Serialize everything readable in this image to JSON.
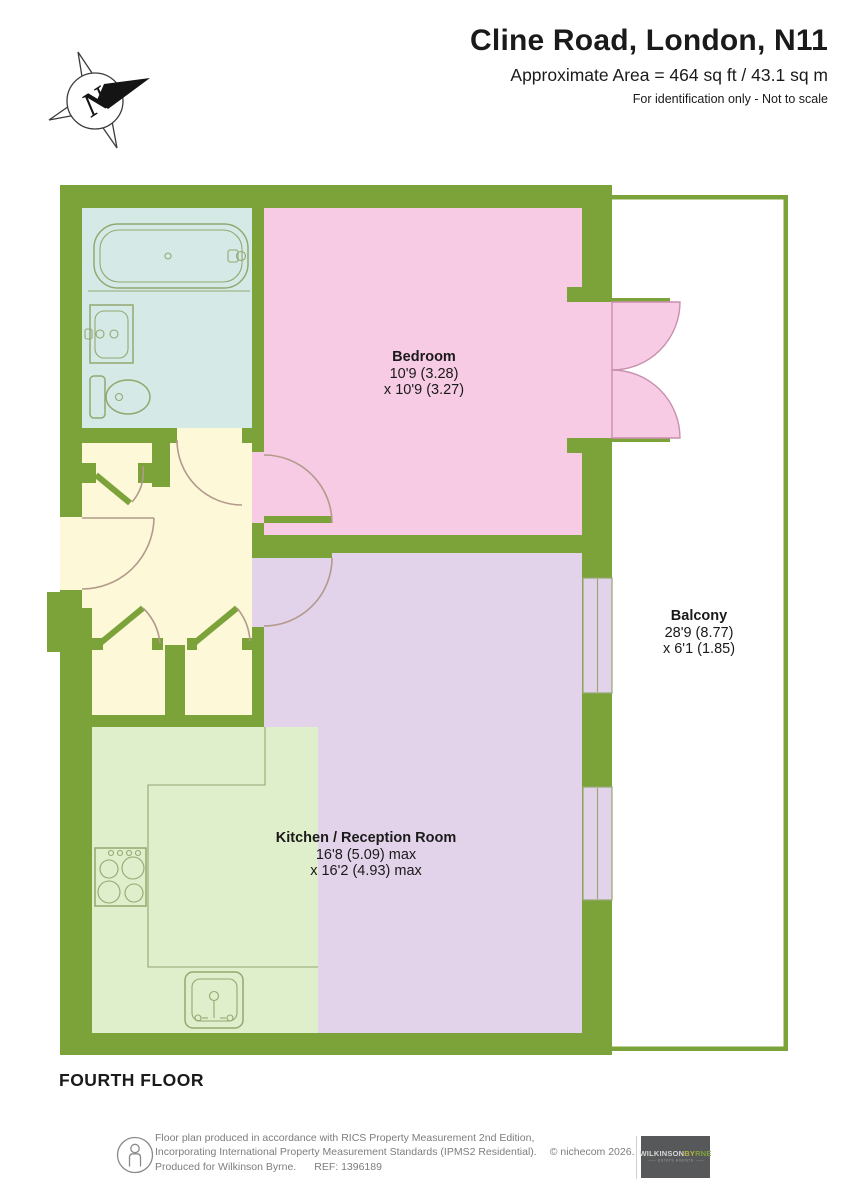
{
  "header": {
    "title": "Cline Road, London, N11",
    "area": "Approximate Area = 464 sq ft / 43.1 sq m",
    "disclaimer": "For identification only - Not to scale"
  },
  "compass": {
    "north_label": "N"
  },
  "plan": {
    "floor_label": "FOURTH FLOOR",
    "rooms": [
      {
        "name": "Bedroom",
        "dim_line1": "10'9 (3.28)",
        "dim_line2": "x 10'9 (3.27)"
      },
      {
        "name": "Balcony",
        "dim_line1": "28'9 (8.77)",
        "dim_line2": "x 6'1 (1.85)"
      },
      {
        "name": "Kitchen / Reception Room",
        "dim_line1": "16'8 (5.09) max",
        "dim_line2": "x 16'2 (4.93) max"
      }
    ]
  },
  "footer": {
    "line1": "Floor plan produced in accordance with RICS Property Measurement 2nd Edition,",
    "line2": "Incorporating International Property Measurement Standards (IPMS2 Residential).",
    "copyright": "© nichecom 2026.",
    "produced_for": "Produced for Wilkinson Byrne.",
    "ref": "REF: 1396189",
    "logo": {
      "part1": "WILKINSON",
      "part2a": "BY",
      "part2b": "RNE",
      "tagline": "ESTATE AGENTS"
    }
  },
  "colors": {
    "wall": "#7CA23A",
    "bedroom": "#F7CBE4",
    "reception": "#E2D3EA",
    "hallway": "#FCF8D8",
    "bathroom": "#D5EAE7",
    "kitchen": "#DFEECB",
    "balcony": "#FFFFFF",
    "fixture-line": "#93A871",
    "door-arc": "#B29A8C",
    "french-door-line": "#C98FAE",
    "text": "#1A1A1A",
    "footer-text": "#7D7D7D",
    "logo-bg": "#57585A",
    "logo-part1": "#D8D8D6",
    "logo-part2a": "#B7BA3D",
    "logo-part2b": "#7FA43D"
  }
}
